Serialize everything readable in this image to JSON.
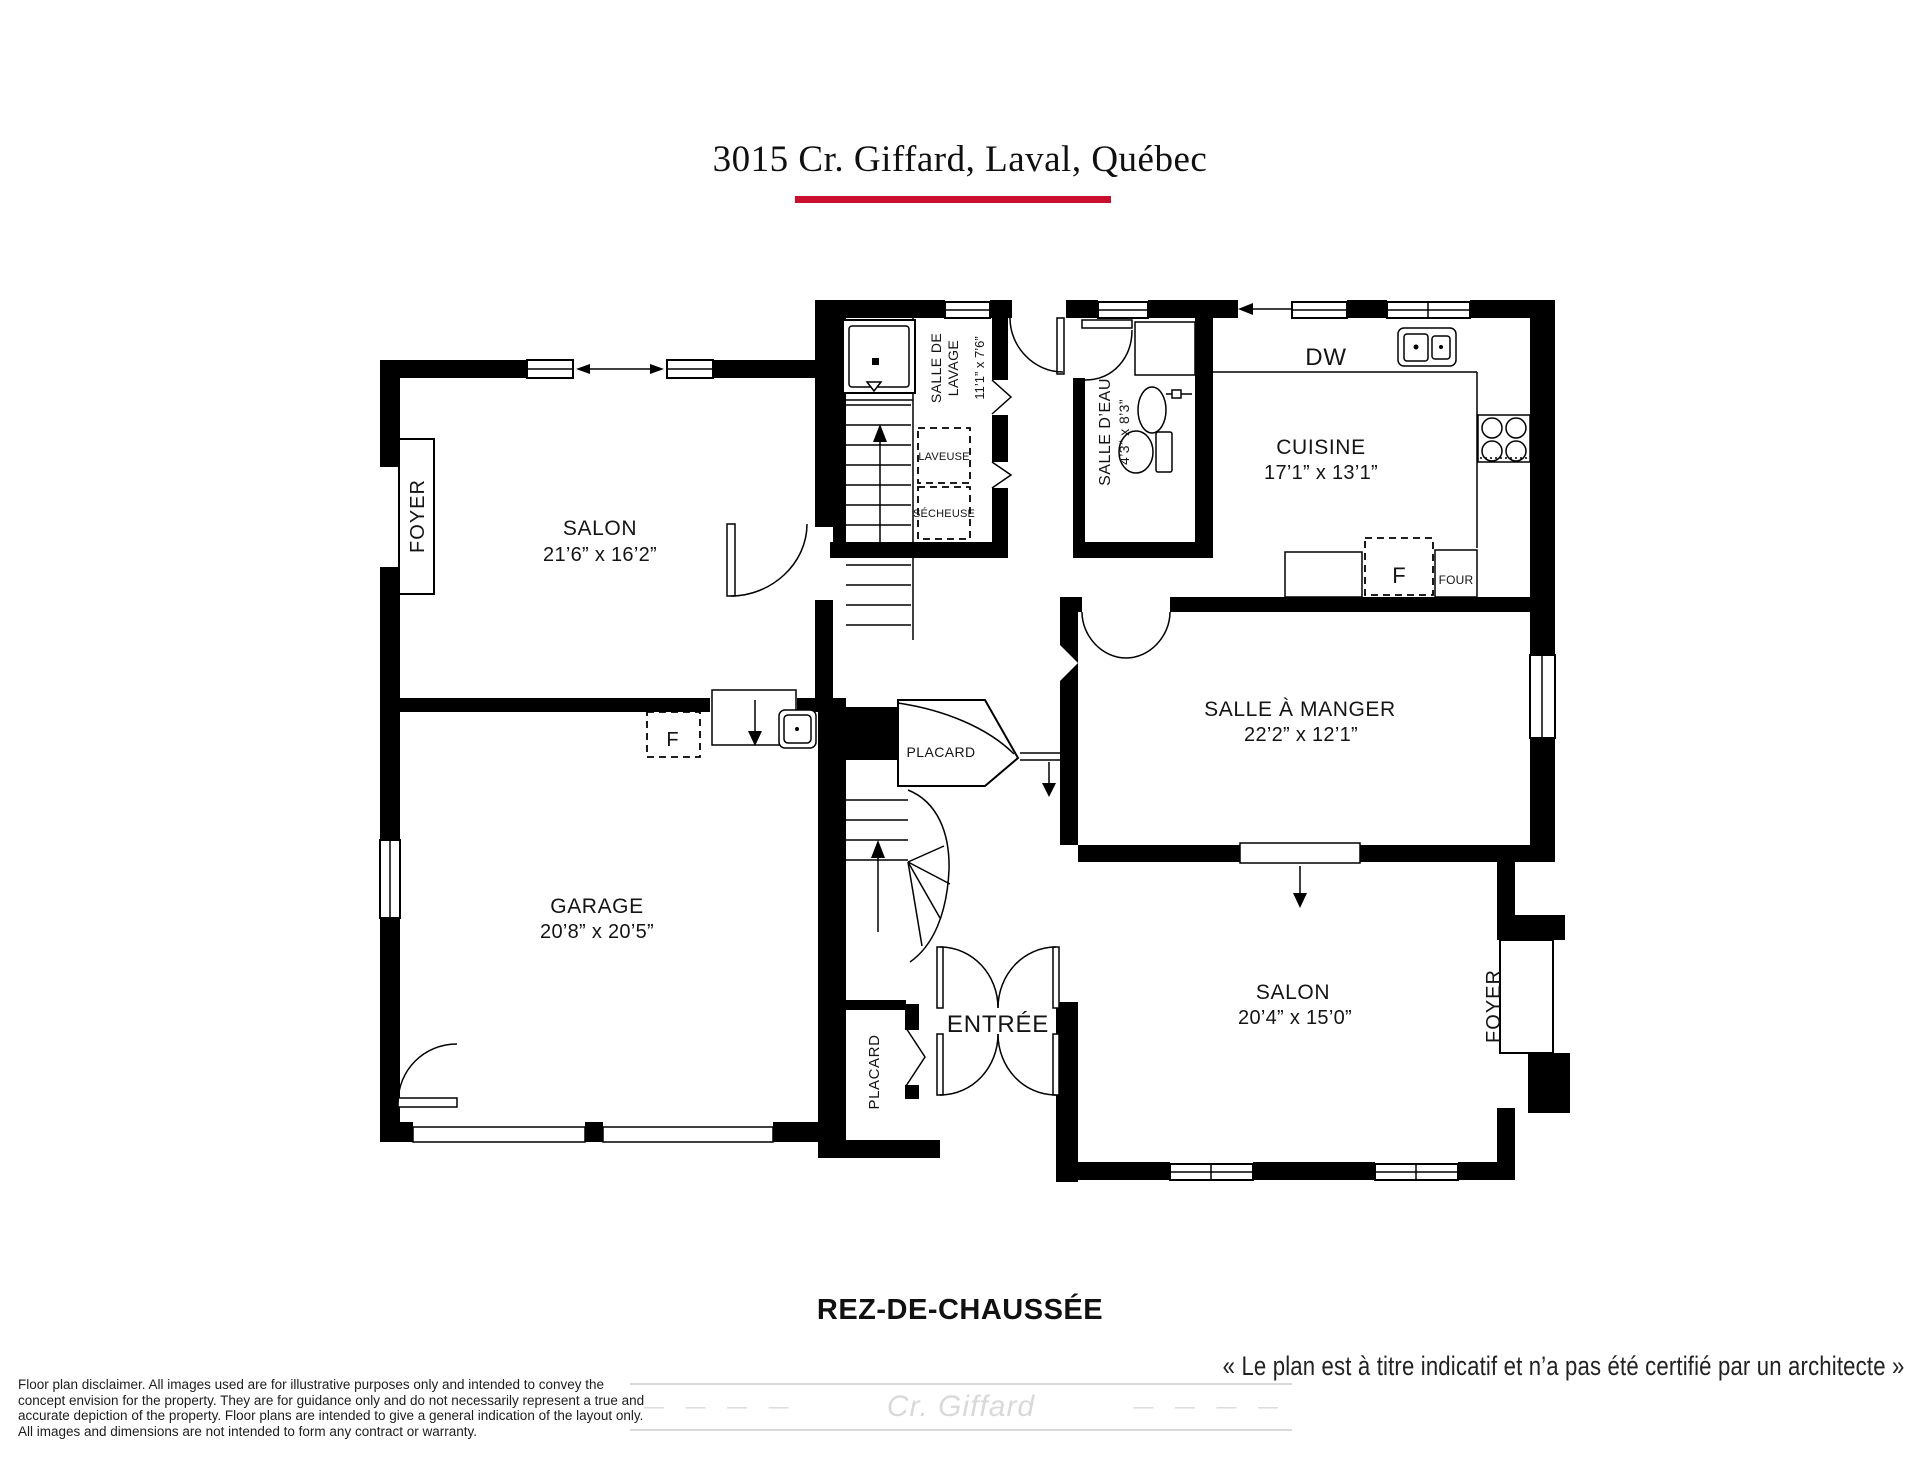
{
  "header": {
    "title": "3015 Cr. Giffard, Laval, Québec",
    "underline_color": "#c8102e"
  },
  "plan": {
    "rooms": {
      "salon_haut": {
        "name": "SALON",
        "dims": "21’6” x 16’2”"
      },
      "cuisine": {
        "name": "CUISINE",
        "dims": "17’1” x 13’1”"
      },
      "salle_a_manger": {
        "name": "SALLE À MANGER",
        "dims": "22’2” x 12’1”"
      },
      "garage": {
        "name": "GARAGE",
        "dims": "20’8” x 20’5”"
      },
      "salon_bas": {
        "name": "SALON",
        "dims": "20’4” x 15’0”"
      },
      "salle_de_lavage": {
        "line1": "SALLE DE",
        "line2": "LAVAGE",
        "dims": "11’1” x 7’6”"
      },
      "salle_d_eau": {
        "name": "SALLE D’EAU",
        "dims": "4’3” x 8’3”"
      },
      "entree": {
        "name": "ENTRÉE"
      },
      "foyer_gauche": {
        "name": "FOYER"
      },
      "foyer_droit": {
        "name": "FOYER"
      },
      "placard_couloir": {
        "name": "PLACARD"
      },
      "placard_entree": {
        "name": "PLACARD"
      }
    },
    "appliances": {
      "dishwasher": "DW",
      "refrigerator": "F",
      "freezer": "F",
      "oven": "FOUR",
      "washer": "LAVEUSE",
      "dryer": "SÉCHEUSE"
    }
  },
  "footer": {
    "floor_label": "REZ-DE-CHAUSSÉE",
    "note": "« Le plan est à titre indicatif et n’a pas été certifié par un architecte »",
    "watermark": {
      "text": "Cr. Giffard",
      "dashes_left": "— — — —",
      "dashes_right": "— — — —",
      "color": "#d9d9d9"
    },
    "disclaimer_lines": [
      "Floor plan disclaimer. All images used are for illustrative purposes only and intended to convey the",
      "concept envision for the property. They are for guidance only and do not necessarily represent a true and",
      "accurate depiction of the property. Floor plans are intended to give a general indication of the layout only.",
      "All images and dimensions are not intended to form any contract or warranty."
    ]
  }
}
